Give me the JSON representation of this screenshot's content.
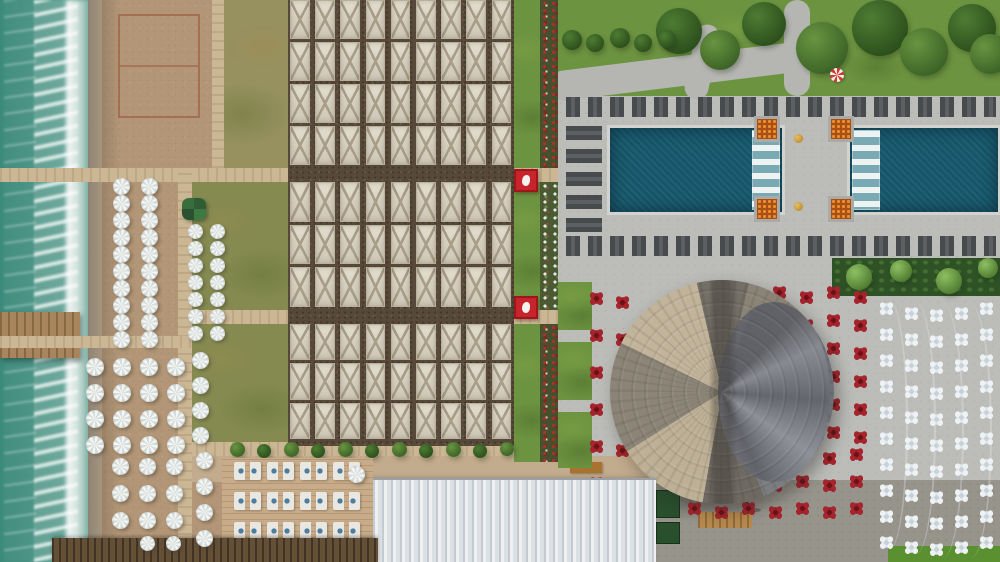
{
  "scene_type": "aerial-beach-resort-photo",
  "palette": {
    "sea": "#4e9688",
    "foam": "#f0f3ee",
    "sand": "#b29677",
    "wet_sand": "#8e8374",
    "grass_olive": "#96915f",
    "lawn_green": "#6c9340",
    "hedge": "#2e5226",
    "pavement": "#bcbdb9",
    "path_wood": "#ccb795",
    "boardwalk": "#5d4a34",
    "cabana_roof": "#dcd7c7",
    "cabana_ridge": "#a89e8a",
    "cabana_ground": "#574939",
    "kiosk_red": "#c8242b",
    "flower_red": "#b03026",
    "pool_deep": "#15566a",
    "pool_shelf": "#79aab4",
    "planter_orange": "#a84f16",
    "lounger_dark": "#3e4144",
    "lounger_cushion_blue": "#4d7d9e",
    "thatch_beige": "#c2b49b",
    "thatch_gray": "#8b8376",
    "thatch_dark": "#6f7076",
    "table_red": "#93202a",
    "table_white": "#eef2f4",
    "metal_roof_white": "#e3e6e9",
    "deck_wood": "#c8ac8a",
    "service_gray": "#97948c"
  },
  "scene": {
    "umbrella_groups": [
      {
        "x": 113,
        "y": 178,
        "cols": 2,
        "rows": 10,
        "dx": 28,
        "dy": 17,
        "size": 17
      },
      {
        "x": 188,
        "y": 224,
        "cols": 2,
        "rows": 7,
        "dx": 22,
        "dy": 17,
        "size": 15
      },
      {
        "x": 86,
        "y": 358,
        "cols": 4,
        "rows": 4,
        "dx": 27,
        "dy": 26,
        "size": 18
      },
      {
        "x": 192,
        "y": 352,
        "cols": 1,
        "rows": 4,
        "dx": 0,
        "dy": 25,
        "size": 17
      },
      {
        "x": 112,
        "y": 458,
        "cols": 3,
        "rows": 3,
        "dx": 27,
        "dy": 27,
        "size": 17
      },
      {
        "x": 196,
        "y": 452,
        "cols": 1,
        "rows": 4,
        "dx": 0,
        "dy": 26,
        "size": 17
      },
      {
        "x": 140,
        "y": 536,
        "cols": 2,
        "rows": 1,
        "dx": 26,
        "dy": 0,
        "size": 15
      },
      {
        "x": 348,
        "y": 466,
        "cols": 1,
        "rows": 1,
        "dx": 0,
        "dy": 0,
        "size": 17
      }
    ],
    "cabanas": {
      "x": 290,
      "cols": 9,
      "col_w": 19.6,
      "gap": 5.6,
      "bands": [
        {
          "y": 0,
          "h": 168,
          "rows": 4
        },
        {
          "y": 182,
          "h": 128,
          "rows": 3
        },
        {
          "y": 324,
          "h": 118,
          "rows": 3
        }
      ]
    },
    "table_groups": [
      {
        "type": "red",
        "x": 590,
        "y": 292,
        "cols": 2,
        "rows": 6,
        "dx": 26,
        "dy": 37,
        "stagger": 4
      },
      {
        "type": "red",
        "x": 773,
        "y": 286,
        "cols": 4,
        "rows": 6,
        "dx": 27,
        "dy": 28,
        "stagger": 5
      },
      {
        "type": "red",
        "x": 688,
        "y": 448,
        "cols": 7,
        "rows": 3,
        "dx": 27,
        "dy": 27,
        "stagger": 4
      },
      {
        "type": "white",
        "x": 880,
        "y": 302,
        "cols": 5,
        "rows": 10,
        "dx": 25,
        "dy": 26,
        "stagger": 7,
        "curve": true
      }
    ],
    "lounger_rows": [
      {
        "x": 566,
        "y": 97,
        "w": 430,
        "h": 20
      },
      {
        "x": 566,
        "y": 236,
        "w": 430,
        "h": 20
      }
    ],
    "lounger_cols": [
      {
        "x": 566,
        "y": 126,
        "w": 36,
        "h": 106
      }
    ],
    "deck_loungers": {
      "x": 234,
      "y": 462,
      "cols": 4,
      "rows": 3,
      "dx": 33,
      "dy": 30
    },
    "planters": [
      [
        754,
        116
      ],
      [
        754,
        196
      ],
      [
        828,
        116
      ],
      [
        828,
        196
      ]
    ],
    "trees_top": [
      [
        656,
        8,
        46,
        0
      ],
      [
        700,
        30,
        40,
        1
      ],
      [
        742,
        2,
        44,
        0
      ],
      [
        796,
        22,
        52,
        1
      ],
      [
        852,
        0,
        56,
        0
      ],
      [
        900,
        28,
        48,
        1
      ],
      [
        948,
        4,
        48,
        0
      ],
      [
        970,
        34,
        40,
        1
      ],
      [
        562,
        30,
        20,
        0
      ],
      [
        586,
        34,
        18,
        0
      ],
      [
        610,
        28,
        20,
        0
      ],
      [
        634,
        34,
        18,
        0
      ],
      [
        658,
        30,
        18,
        0
      ]
    ],
    "palms": [
      [
        846,
        264,
        26,
        2
      ],
      [
        890,
        260,
        22,
        2
      ],
      [
        936,
        268,
        26,
        2
      ],
      [
        978,
        258,
        20,
        2
      ]
    ],
    "trees_row": [
      [
        230,
        442,
        15,
        1
      ],
      [
        257,
        444,
        14,
        0
      ],
      [
        284,
        442,
        15,
        1
      ],
      [
        311,
        444,
        14,
        0
      ],
      [
        338,
        442,
        15,
        1
      ],
      [
        365,
        444,
        14,
        0
      ],
      [
        392,
        442,
        15,
        1
      ],
      [
        419,
        444,
        14,
        0
      ],
      [
        446,
        442,
        15,
        1
      ],
      [
        473,
        444,
        14,
        0
      ],
      [
        500,
        442,
        14,
        1
      ]
    ]
  }
}
